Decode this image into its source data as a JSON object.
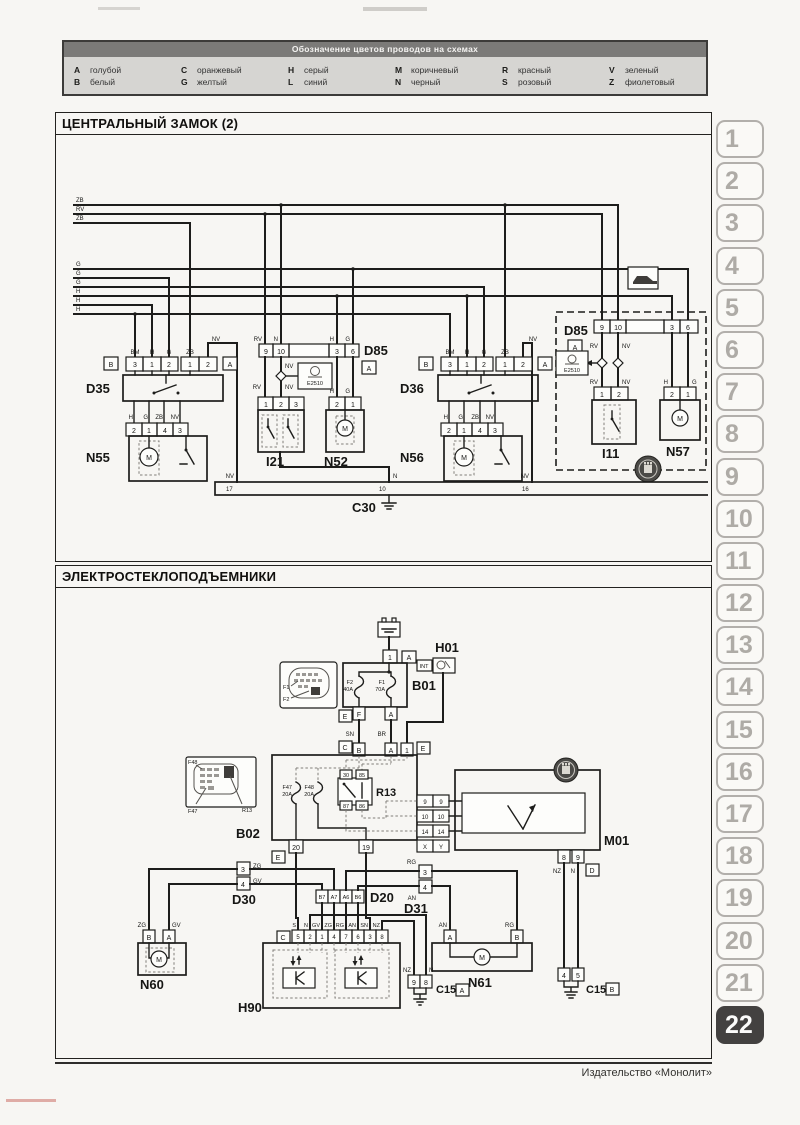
{
  "legend": {
    "title": "Обозначение цветов проводов на схемах",
    "entries": [
      {
        "code": "A",
        "name": "голубой"
      },
      {
        "code": "B",
        "name": "белый"
      },
      {
        "code": "C",
        "name": "оранжевый"
      },
      {
        "code": "G",
        "name": "желтый"
      },
      {
        "code": "H",
        "name": "серый"
      },
      {
        "code": "L",
        "name": "синий"
      },
      {
        "code": "M",
        "name": "коричневый"
      },
      {
        "code": "N",
        "name": "черный"
      },
      {
        "code": "R",
        "name": "красный"
      },
      {
        "code": "S",
        "name": "розовый"
      },
      {
        "code": "V",
        "name": "зеленый"
      },
      {
        "code": "Z",
        "name": "фиолетовый"
      }
    ]
  },
  "d1": {
    "title": "ЦЕНТРАЛЬНЫЙ ЗАМОК (2)",
    "bus": [
      "ZB",
      "RV",
      "ZB",
      "G",
      "G",
      "G",
      "H",
      "H",
      "H"
    ],
    "d35": {
      "name": "D35",
      "b": "B",
      "a": "A",
      "pins": [
        "3",
        "1",
        "2",
        "1",
        "2"
      ],
      "top": [
        "BM",
        "H",
        "G",
        "ZB"
      ],
      "nv": "NV",
      "bot": [
        "H",
        "G",
        "ZB",
        "NV"
      ]
    },
    "n55": {
      "name": "N55",
      "pins": [
        "2",
        "1",
        "4",
        "3"
      ],
      "m": "M"
    },
    "d85m": {
      "name": "D85",
      "a": "A",
      "pins": [
        "9",
        "10",
        "3",
        "6"
      ],
      "top": [
        "RV",
        "N",
        "H",
        "G"
      ],
      "nv": "NV",
      "low": [
        "RV",
        "NV"
      ]
    },
    "e2510m": "E2510",
    "i21": {
      "name": "I21",
      "pins": [
        "1",
        "2",
        "3"
      ]
    },
    "n52": {
      "name": "N52",
      "pins": [
        "2",
        "1"
      ],
      "top": [
        "H",
        "G"
      ],
      "m": "M"
    },
    "d36": {
      "name": "D36",
      "b": "B",
      "a": "A",
      "pins": [
        "3",
        "1",
        "2",
        "1",
        "2"
      ],
      "top": [
        "BM",
        "H",
        "G",
        "ZB"
      ],
      "nv": "NV",
      "bot": [
        "H",
        "G",
        "ZB",
        "NV"
      ]
    },
    "n56": {
      "name": "N56",
      "pins": [
        "2",
        "1",
        "4",
        "3"
      ],
      "m": "M"
    },
    "dbox": {
      "name": "D85",
      "a": "A",
      "pins": [
        "9",
        "10",
        "3",
        "6"
      ],
      "lab1": [
        "RV",
        "NV"
      ],
      "lab2": [
        "RV",
        "NV"
      ],
      "e2510": "E2510",
      "i11": {
        "name": "I11",
        "pins": [
          "1",
          "2"
        ]
      },
      "n57": {
        "name": "N57",
        "pins": [
          "2",
          "1"
        ],
        "top": [
          "H",
          "G"
        ],
        "m": "M"
      }
    },
    "c30": {
      "name": "C30",
      "pins": [
        "17",
        "10",
        "16"
      ],
      "w": [
        "NV",
        "N",
        "NV"
      ]
    }
  },
  "d2": {
    "title": "ЭЛЕКТРОСТЕКЛОПОДЪЕМНИКИ",
    "conn1": {
      "pin": "1",
      "a": "A"
    },
    "b01": {
      "name": "B01",
      "f2": "F2",
      "f2a": "40A",
      "f1": "F1",
      "f1a": "70A",
      "pf": "F",
      "pa": "A",
      "e": "E"
    },
    "fusebox": {
      "f1": "F1",
      "f2": "F2"
    },
    "h01": {
      "name": "H01",
      "int": "INT"
    },
    "sn": "SN",
    "br": "BR",
    "row": {
      "c": "C",
      "b": "B",
      "a": "A",
      "one": "1",
      "e": "E"
    },
    "b02": {
      "name": "B02",
      "f47": "F47",
      "f47a": "20A",
      "f48": "F48",
      "f48a": "20A",
      "r13": "R13",
      "p30": "30",
      "p85": "85",
      "p87": "87",
      "p86": "86",
      "p20": "20",
      "p19": "19",
      "e": "E"
    },
    "fusebox2": {
      "f48": "F48",
      "f47": "F47",
      "r13": "R13"
    },
    "mcols": {
      "l": [
        "9",
        "10",
        "14"
      ],
      "r": [
        "9",
        "10",
        "14"
      ],
      "ids": [
        "X",
        "Y"
      ]
    },
    "m01": {
      "name": "M01",
      "p8": "8",
      "p9": "9",
      "nz": "NZ",
      "n": "N",
      "d": "D"
    },
    "d30": {
      "name": "D30",
      "p3": "3",
      "p4": "4",
      "zg": "ZG",
      "gv": "GV"
    },
    "n60": {
      "name": "N60",
      "pb": "B",
      "pa": "A",
      "zg": "ZG",
      "gv": "GV",
      "m": "M"
    },
    "d20": {
      "name": "D20",
      "pins": [
        "B7",
        "A7",
        "A6",
        "B6"
      ]
    },
    "d31": {
      "name": "D31",
      "p3": "3",
      "p4": "4",
      "rg": "RG",
      "an": "AN"
    },
    "n61": {
      "name": "N61",
      "pa": "A",
      "pb": "B",
      "an": "AN",
      "rg": "RG",
      "m": "M"
    },
    "h90": {
      "name": "H90",
      "c": "C",
      "pins": [
        "5",
        "2",
        "1",
        "4",
        "7",
        "6",
        "3",
        "8"
      ],
      "wires": [
        "S",
        "N",
        "GV",
        "ZG",
        "RG",
        "AN",
        "SN",
        "NZ"
      ]
    },
    "c15a": {
      "name": "C15",
      "id": "A",
      "p1": "9",
      "p2": "8",
      "nz": "NZ",
      "n": "N"
    },
    "c15b": {
      "name": "C15",
      "id": "B",
      "p1": "4",
      "p2": "5",
      "nz": "NZ",
      "n": "N"
    }
  },
  "sidebar": {
    "tabs": [
      "1",
      "2",
      "3",
      "4",
      "5",
      "6",
      "7",
      "8",
      "9",
      "10",
      "11",
      "12",
      "13",
      "14",
      "15",
      "16",
      "17",
      "18",
      "19",
      "20",
      "21",
      "22"
    ],
    "active": "22"
  },
  "footer": {
    "publisher": "Издательство «Монолит»"
  }
}
